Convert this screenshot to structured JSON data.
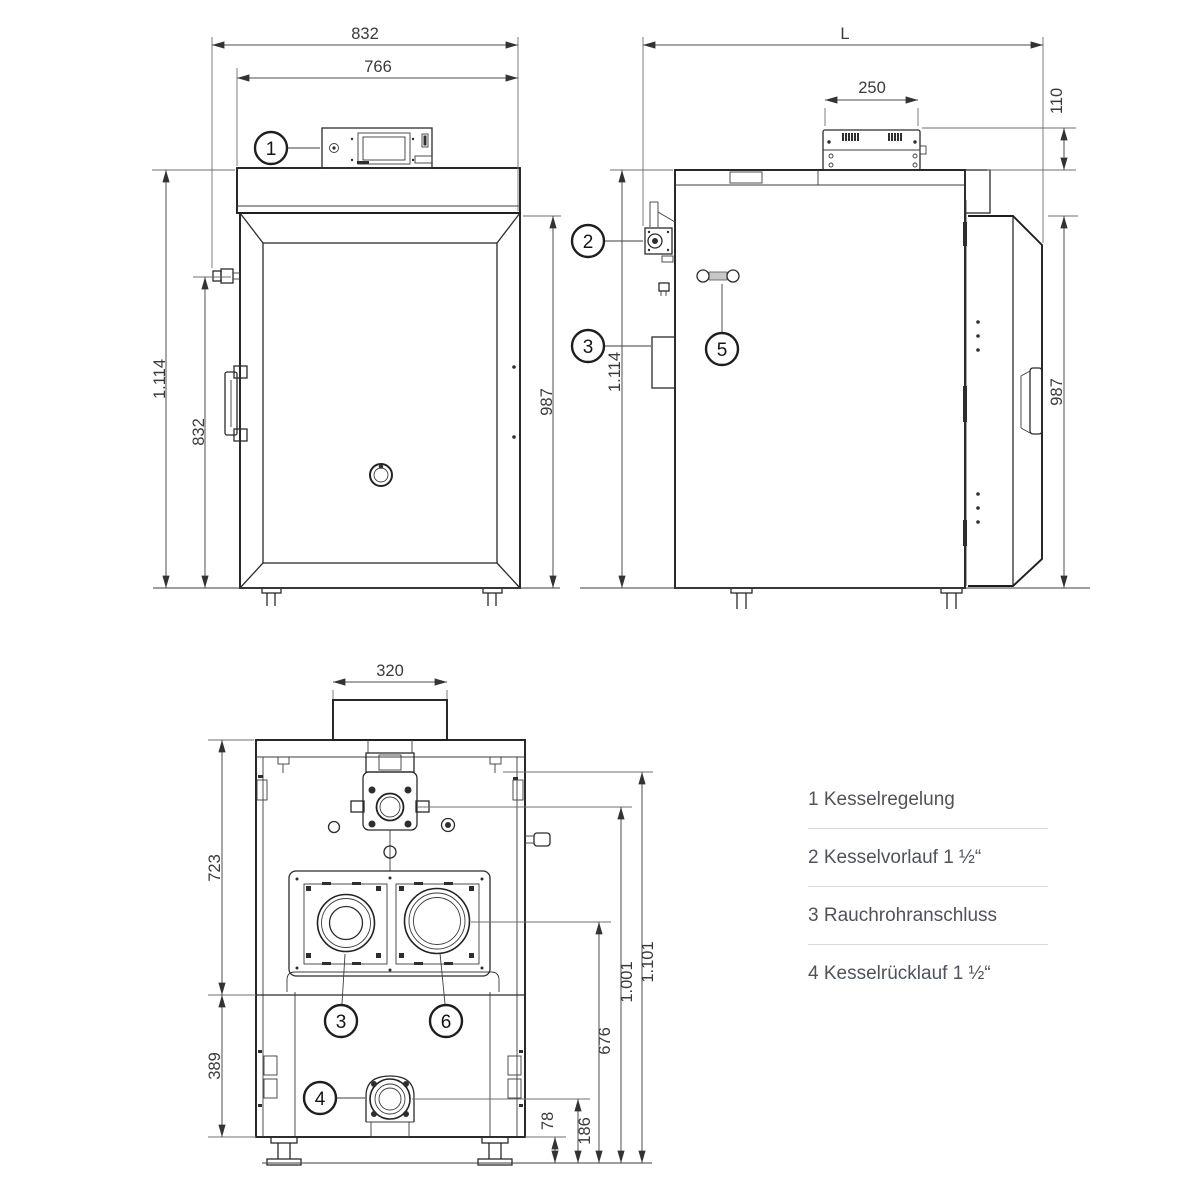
{
  "dims": {
    "front": {
      "total_width": "832",
      "body_width": "766",
      "total_height": "1.114",
      "side_height": "832",
      "door_height": "987"
    },
    "side": {
      "length": "L",
      "box_width": "250",
      "box_height": "110",
      "total_height": "1.114",
      "door_height": "987"
    },
    "rear": {
      "flue_width": "320",
      "upper_height": "723",
      "lower_height": "389",
      "flue_center": "676",
      "flow_center": "1.001",
      "top_edge": "1.101",
      "leg_height": "78",
      "return_center": "186"
    }
  },
  "callouts": {
    "c1": "1",
    "c2": "2",
    "c3": "3",
    "c4": "4",
    "c5": "5",
    "c6": "6"
  },
  "legend": {
    "items": [
      {
        "number": "1",
        "label": "Kesselregelung"
      },
      {
        "number": "2",
        "label": "Kesselvorlauf 1 ½“"
      },
      {
        "number": "3",
        "label": "Rauchrohranschluss"
      },
      {
        "number": "4",
        "label": "Kesselrücklauf 1 ½“"
      }
    ]
  }
}
